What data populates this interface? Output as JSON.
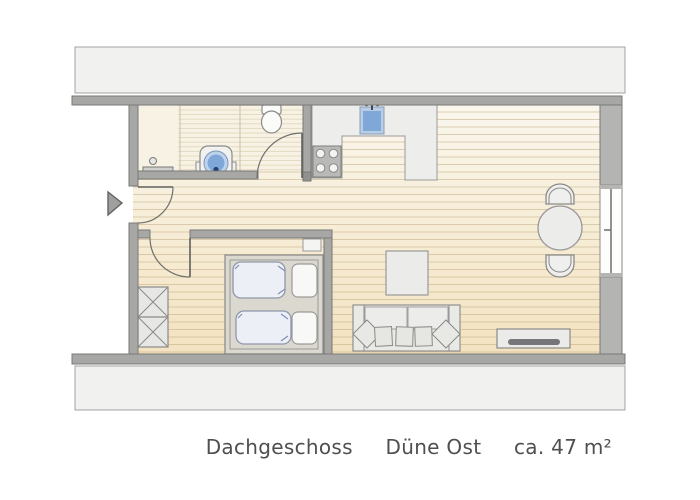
{
  "caption": {
    "floor": "Dachgeschoss",
    "name": "Düne Ost",
    "area": "ca. 47 m²"
  },
  "colors": {
    "background": "#ffffff",
    "roof_band_fill": "#f1f1ef",
    "roof_band_border": "#a3a3a1",
    "wall_fill": "#a7a7a5",
    "wall_fill_right": "#b4b4b2",
    "wall_outline": "#787876",
    "floor_gradient_top": "#faf7ee",
    "floor_gradient_bottom": "#f3e2c0",
    "plank_line": "#c3ad85",
    "bathroom_floor": "#f7f2e4",
    "counter_fill": "#ededeb",
    "stove_fill": "#b9b9b7",
    "furniture_fill": "#ebebe8",
    "furniture_outline": "#8f8f8d",
    "water_blue": "#7fa8d9",
    "water_blue_light": "#bed3ec",
    "mattress_fill": "#eceff6",
    "pillow_fill": "#f8f8f7",
    "tv_bar": "#76767a",
    "caption_text": "#4f4f4f"
  },
  "fixtures": [
    "entrance-arrow",
    "entrance-door",
    "bathroom-door",
    "bedroom-door",
    "toilet",
    "washbasin",
    "towel-rail",
    "kitchen-counter",
    "stove",
    "kitchen-sink",
    "wardrobe",
    "double-bed",
    "nightstand",
    "coffee-table",
    "sofa",
    "dining-table",
    "dining-chair",
    "sideboard-tv",
    "window"
  ]
}
